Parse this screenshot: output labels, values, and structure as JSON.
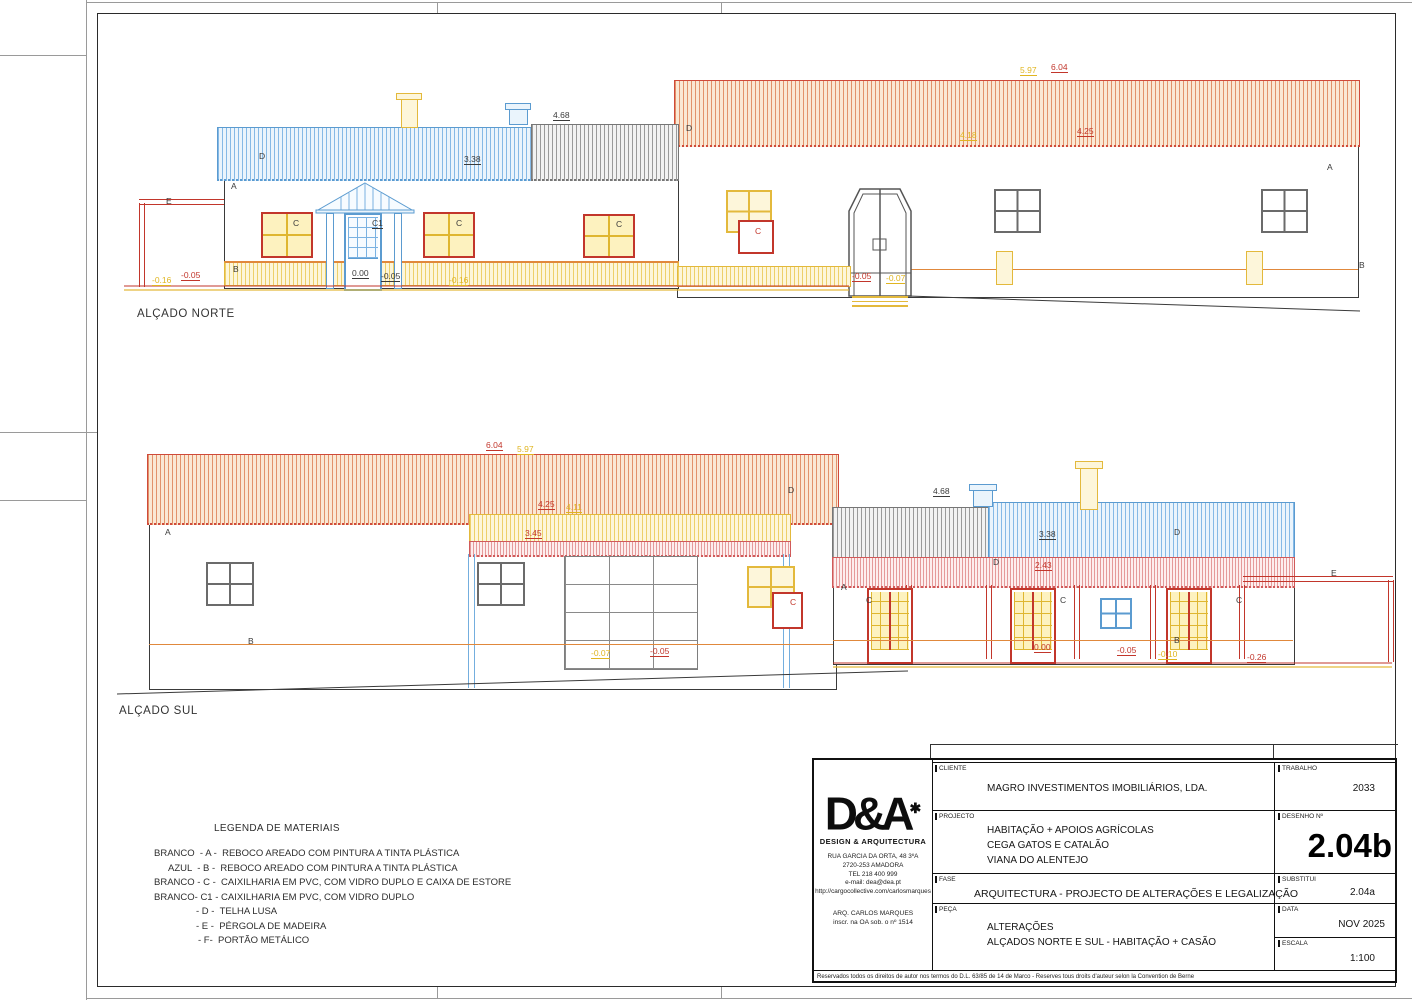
{
  "north": {
    "label": "ALÇADO NORTE",
    "annotations": [
      {
        "t": "E",
        "x": 166,
        "y": 197,
        "c": "dark"
      },
      {
        "t": "D",
        "x": 259,
        "y": 152,
        "c": "dark"
      },
      {
        "t": "A",
        "x": 231,
        "y": 182,
        "c": "dark"
      },
      {
        "t": "B",
        "x": 233,
        "y": 265,
        "c": "dark"
      },
      {
        "t": "C",
        "x": 293,
        "y": 219,
        "c": "dark"
      },
      {
        "t": "C1",
        "x": 372,
        "y": 219,
        "c": "dark"
      },
      {
        "t": "C",
        "x": 456,
        "y": 219,
        "c": "dark"
      },
      {
        "t": "C",
        "x": 616,
        "y": 220,
        "c": "dark"
      },
      {
        "t": "D",
        "x": 686,
        "y": 124,
        "c": "dark"
      },
      {
        "t": "C",
        "x": 755,
        "y": 227,
        "c": "red"
      },
      {
        "t": "A",
        "x": 1327,
        "y": 163,
        "c": "dark"
      },
      {
        "t": "B",
        "x": 1359,
        "y": 261,
        "c": "dark"
      },
      {
        "t": "4.68",
        "x": 553,
        "y": 111,
        "c": "dark"
      },
      {
        "t": "3.38",
        "x": 464,
        "y": 155,
        "c": "dark"
      },
      {
        "t": "5.97",
        "x": 1020,
        "y": 66,
        "c": "yellow"
      },
      {
        "t": "6.04",
        "x": 1051,
        "y": 63,
        "c": "red"
      },
      {
        "t": "4.18",
        "x": 960,
        "y": 131,
        "c": "yellow"
      },
      {
        "t": "4.25",
        "x": 1077,
        "y": 127,
        "c": "red"
      },
      {
        "t": "-0.16",
        "x": 152,
        "y": 276,
        "c": "yellow"
      },
      {
        "t": "-0.05",
        "x": 181,
        "y": 271,
        "c": "red"
      },
      {
        "t": "0.00",
        "x": 352,
        "y": 269,
        "c": "dark"
      },
      {
        "t": "-0.05",
        "x": 381,
        "y": 272,
        "c": "dark"
      },
      {
        "t": "-0.16",
        "x": 449,
        "y": 276,
        "c": "yellow"
      },
      {
        "t": "-0.05",
        "x": 852,
        "y": 272,
        "c": "red"
      },
      {
        "t": "-0.07",
        "x": 886,
        "y": 274,
        "c": "yellow"
      }
    ]
  },
  "south": {
    "label": "ALÇADO SUL",
    "annotations": [
      {
        "t": "6.04",
        "x": 486,
        "y": 441,
        "c": "red"
      },
      {
        "t": "5.97",
        "x": 517,
        "y": 445,
        "c": "yellow"
      },
      {
        "t": "4.25",
        "x": 538,
        "y": 500,
        "c": "red"
      },
      {
        "t": "4.11",
        "x": 566,
        "y": 503,
        "c": "yellow"
      },
      {
        "t": "3.45",
        "x": 525,
        "y": 529,
        "c": "red"
      },
      {
        "t": "A",
        "x": 165,
        "y": 528,
        "c": "dark"
      },
      {
        "t": "B",
        "x": 248,
        "y": 637,
        "c": "dark"
      },
      {
        "t": "D",
        "x": 788,
        "y": 486,
        "c": "dark"
      },
      {
        "t": "-0.07",
        "x": 591,
        "y": 649,
        "c": "yellow"
      },
      {
        "t": "-0.05",
        "x": 650,
        "y": 647,
        "c": "red"
      },
      {
        "t": "4.68",
        "x": 933,
        "y": 487,
        "c": "dark"
      },
      {
        "t": "3.38",
        "x": 1039,
        "y": 530,
        "c": "dark"
      },
      {
        "t": "D",
        "x": 1174,
        "y": 528,
        "c": "dark"
      },
      {
        "t": "D",
        "x": 993,
        "y": 558,
        "c": "dark"
      },
      {
        "t": "2.43",
        "x": 1035,
        "y": 561,
        "c": "red"
      },
      {
        "t": "A",
        "x": 841,
        "y": 583,
        "c": "dark"
      },
      {
        "t": "C",
        "x": 866,
        "y": 596,
        "c": "dark"
      },
      {
        "t": "C",
        "x": 1060,
        "y": 596,
        "c": "dark"
      },
      {
        "t": "C",
        "x": 1236,
        "y": 596,
        "c": "dark"
      },
      {
        "t": "C",
        "x": 790,
        "y": 598,
        "c": "red"
      },
      {
        "t": "B",
        "x": 1174,
        "y": 636,
        "c": "dark"
      },
      {
        "t": "E",
        "x": 1331,
        "y": 569,
        "c": "dark"
      },
      {
        "t": "0.00",
        "x": 1034,
        "y": 643,
        "c": "red"
      },
      {
        "t": "-0.05",
        "x": 1117,
        "y": 646,
        "c": "red"
      },
      {
        "t": "-0.10",
        "x": 1158,
        "y": 650,
        "c": "yellow"
      },
      {
        "t": "-0.26",
        "x": 1247,
        "y": 653,
        "c": "red"
      }
    ]
  },
  "legend": {
    "title": "LEGENDA DE MATERIAIS",
    "items": [
      {
        "text": "BRANCO  - A -  REBOCO AREADO COM PINTURA A TINTA PLÁSTICA",
        "indent": 0
      },
      {
        "text": "AZUL  - B -  REBOCO AREADO COM PINTURA A TINTA PLÁSTICA",
        "indent": 14
      },
      {
        "text": "BRANCO - C -  CAIXILHARIA EM PVC, COM VIDRO DUPLO E CAIXA DE ESTORE",
        "indent": 0
      },
      {
        "text": "BRANCO- C1 - CAIXILHARIA EM PVC, COM VIDRO DUPLO",
        "indent": 0
      },
      {
        "text": "- D -  TELHA LUSA",
        "indent": 42
      },
      {
        "text": "- E -  PÉRGOLA DE MADEIRA",
        "indent": 42
      },
      {
        "text": "- F-  PORTÃO METÁLICO",
        "indent": 44
      }
    ]
  },
  "titleblock": {
    "logo": {
      "mark": "D&A",
      "dot": "✱",
      "sub": "DESIGN  &  ARQUITECTURA",
      "address": [
        "RUA GARCIA DA ORTA, 48 3ºA",
        "2720-253 AMADORA",
        "TEL 218 400 999",
        "e-mail: dea@dea.pt",
        "http://cargocollective.com/carlosmarques"
      ],
      "architect": [
        "ARQ. CARLOS MARQUES",
        "inscr. na OA sob. o nº 1514"
      ]
    },
    "cliente_label": "CLIENTE",
    "cliente": "MAGRO INVESTIMENTOS IMOBILIÁRIOS, LDA.",
    "trabalho_label": "TRABALHO",
    "trabalho": "2033",
    "projecto_label": "PROJECTO",
    "projecto_lines": [
      "HABITAÇÃO + APOIOS AGRÍCOLAS",
      "CEGA GATOS E CATALÃO",
      "VIANA DO ALENTEJO"
    ],
    "desenho_label": "DESENHO Nº",
    "desenho": "2.04b",
    "fase_label": "FASE",
    "fase": "ARQUITECTURA - PROJECTO DE ALTERAÇÕES E LEGALIZAÇÃO",
    "substitui_label": "SUBSTITUI",
    "substitui": "2.04a",
    "peca_label": "PEÇA",
    "peca_lines": [
      "ALTERAÇÕES",
      "ALÇADOS NORTE E SUL - HABITAÇÃO + CASÃO"
    ],
    "data_label": "DATA",
    "data": "NOV 2025",
    "escala_label": "ESCALA",
    "escala": "1:100",
    "copyright": "Reservados todos os direitos de autor nos termos do D.L. 63/85 de 14 de Marco - Reserves tous droits d'auteur selon la Convention de Berne"
  },
  "colors": {
    "accent_blue": "#5b9bd0",
    "accent_red": "#c2362b",
    "accent_yellow": "#e3b93c",
    "accent_orange_roof": "#cf4a3a"
  }
}
